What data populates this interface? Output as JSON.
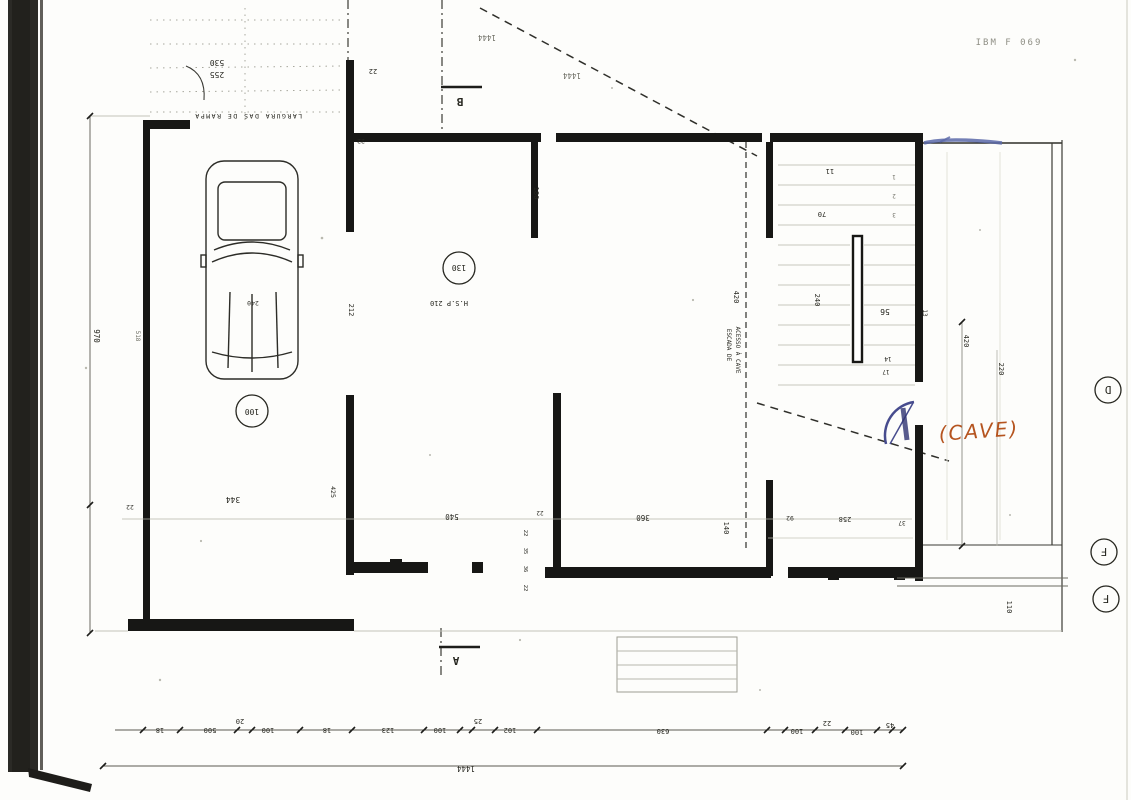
{
  "colors": {
    "ink": "#1c1c1a",
    "paper": "#fdfdfb",
    "blue_pen": "#474c8e",
    "orange_pen": "#b5541f",
    "scan_strip": "#2b2a26"
  },
  "stamp": "IBM F 069",
  "markers": {
    "section_b": "B",
    "section_a": "A",
    "grid_d": "D",
    "grid_f1": "F",
    "grid_f2": "F"
  },
  "rooms": {
    "garage_number": "100",
    "hall_number": "130",
    "ceiling_height": "H.S.P 210",
    "cave_note": "(CAVE)",
    "stair_label_1": "ESCADA DE",
    "stair_label_2": "ACESSO À CAVE",
    "ramp_label": "LARGURA DAS DE RAMPA",
    "car_dim": "240"
  },
  "dims": {
    "top_1": "1444",
    "top_2": "1444",
    "d530": "530",
    "d255": "255",
    "d22a": "22",
    "d22b": "22",
    "d180": "180",
    "d212": "212",
    "d425": "425",
    "d970": "970",
    "d518": "518",
    "d420l": "420",
    "d11": "11",
    "d70": "70",
    "d240s": "240",
    "d56": "56",
    "d13": "13",
    "d14": "14",
    "d17": "17",
    "s1": "1",
    "s2": "2",
    "s3": "3",
    "d344": "344",
    "d22c": "22",
    "d540": "540",
    "d22d": "22",
    "d360": "360",
    "d140": "140",
    "d92": "92",
    "d258": "258",
    "d37": "37",
    "v22a": "22",
    "v35": "35",
    "v36": "36",
    "v22b": "22",
    "d110": "110",
    "d420r": "420",
    "d220": "220",
    "total_width": "1444",
    "bottom_chain": [
      "18",
      "500",
      "20",
      "100",
      "18",
      "123",
      "100",
      "25",
      "102",
      "630",
      "100",
      "22",
      "100",
      "45"
    ]
  }
}
